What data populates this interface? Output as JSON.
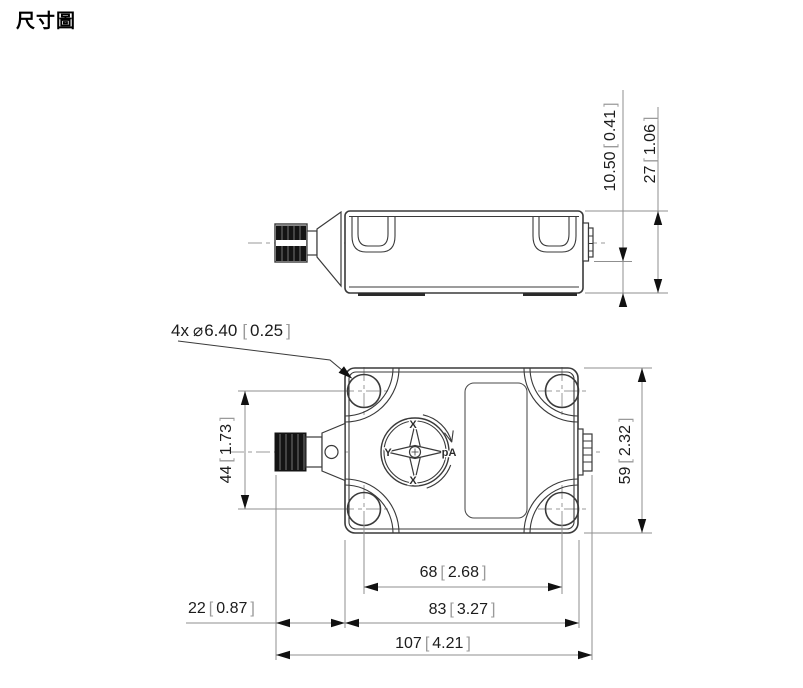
{
  "page": {
    "title": "尺寸圖"
  },
  "symbols": {
    "bracket_open": "[",
    "bracket_close": "]"
  },
  "hole_callout": {
    "count": "4x",
    "diameter_symbol": "⌀",
    "mm": "6.40",
    "inch": "0.25"
  },
  "dimensions": {
    "connector_offset_height": {
      "mm": "10.50",
      "inch": "0.41"
    },
    "housing_thickness": {
      "mm": "27",
      "inch": "1.06"
    },
    "hole_pitch_vertical": {
      "mm": "44",
      "inch": "1.73"
    },
    "housing_height": {
      "mm": "59",
      "inch": "2.32"
    },
    "hole_pitch_horizontal": {
      "mm": "68",
      "inch": "2.68"
    },
    "housing_width": {
      "mm": "83",
      "inch": "3.27"
    },
    "connector_length": {
      "mm": "22",
      "inch": "0.87"
    },
    "overall_length": {
      "mm": "107",
      "inch": "4.21"
    }
  },
  "axis_marker": {
    "top": "X",
    "left": "Y",
    "bottom": "X",
    "mirrored_label": "Aq"
  },
  "colors": {
    "line": "#3a3a3a",
    "dim_line": "#8f8f8f",
    "text": "#1c1c1c",
    "bracket": "#9a9a9a",
    "knurl_fill": "#141414",
    "background": "#ffffff"
  }
}
